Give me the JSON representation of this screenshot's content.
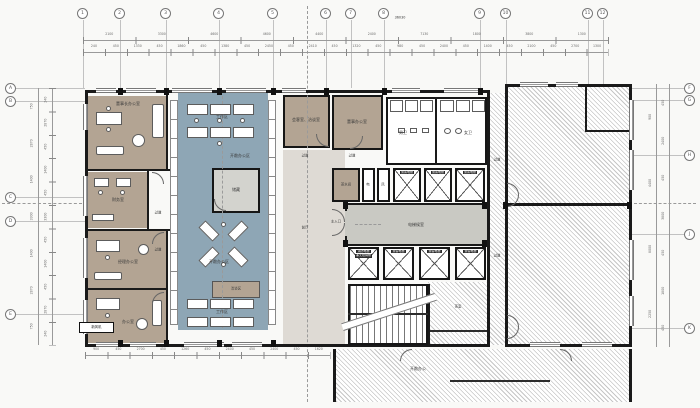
{
  "colors": {
    "paper": "#f9f9f7",
    "tan": "#b3a493",
    "blue": "#8ea6b5",
    "grayroom": "#d3d3ce",
    "lobby": "#c9c9c3",
    "hall": "#dedad4",
    "wall": "#1a1a1a",
    "hatch_line": "#c6c6c6"
  },
  "plan": {
    "grid": {
      "top": [
        "1",
        "2",
        "3",
        "4",
        "5",
        "6",
        "7",
        "8",
        "9",
        "10",
        "11",
        "12"
      ],
      "left": [
        "A",
        "B",
        "C",
        "D",
        "E"
      ],
      "right": [
        "F",
        "G",
        "H",
        "J",
        "K"
      ]
    },
    "dims": {
      "overall": "36030",
      "top_major": [
        "2100",
        "3300",
        "4600",
        "4600",
        "4400",
        "2400",
        "7130",
        "1800",
        "3800",
        "1300"
      ],
      "top_minor": [
        "240",
        "450",
        "1330",
        "450",
        "1860",
        "450",
        "1380",
        "450",
        "2450",
        "450",
        "2410",
        "450",
        "1320",
        "450",
        "980",
        "450",
        "2400",
        "450",
        "1400",
        "450",
        "2100",
        "450",
        "2700",
        "1300"
      ],
      "left_outer": [
        "750",
        "2870",
        "1400",
        "3300",
        "1400",
        "2870",
        "750"
      ],
      "left_inner": [
        "240",
        "2870",
        "450",
        "1400",
        "450",
        "3300",
        "450",
        "1400",
        "450",
        "2870",
        "240"
      ],
      "right_outer": [
        "900",
        "4400",
        "8000",
        "2250"
      ],
      "right_inner": [
        "450",
        "2400",
        "450",
        "3800",
        "450",
        "1800",
        "450"
      ],
      "bottom": [
        "900",
        "450",
        "2700",
        "450",
        "1260",
        "450",
        "2400",
        "450",
        "2400",
        "450",
        "1620"
      ]
    },
    "rooms": {
      "chairman_office": "董事长办公室",
      "finance": "财务室",
      "manager_office": "经理办公室",
      "office": "办公室",
      "storage": "储藏",
      "workstation": "工作区",
      "open_zone": "开敞办公区",
      "lounge": "洽谈区",
      "meeting": "会客室、洽谈室",
      "director_office": "董事办公室",
      "men_wc": "男卫",
      "women_wc": "女卫",
      "pantry": "茶水间",
      "elec": "电",
      "vent": "风",
      "front_hall": "前厅",
      "corridor": "过道",
      "tea_room": "茶室",
      "open_office_shell": "开敞办公",
      "ahu": "新风机"
    },
    "elevators": {
      "lobby": "电梯候室",
      "passenger": "乘客电梯",
      "fire1": "消防电梯",
      "fire2": "兼无障碍梯"
    },
    "entrance": "主入口"
  }
}
